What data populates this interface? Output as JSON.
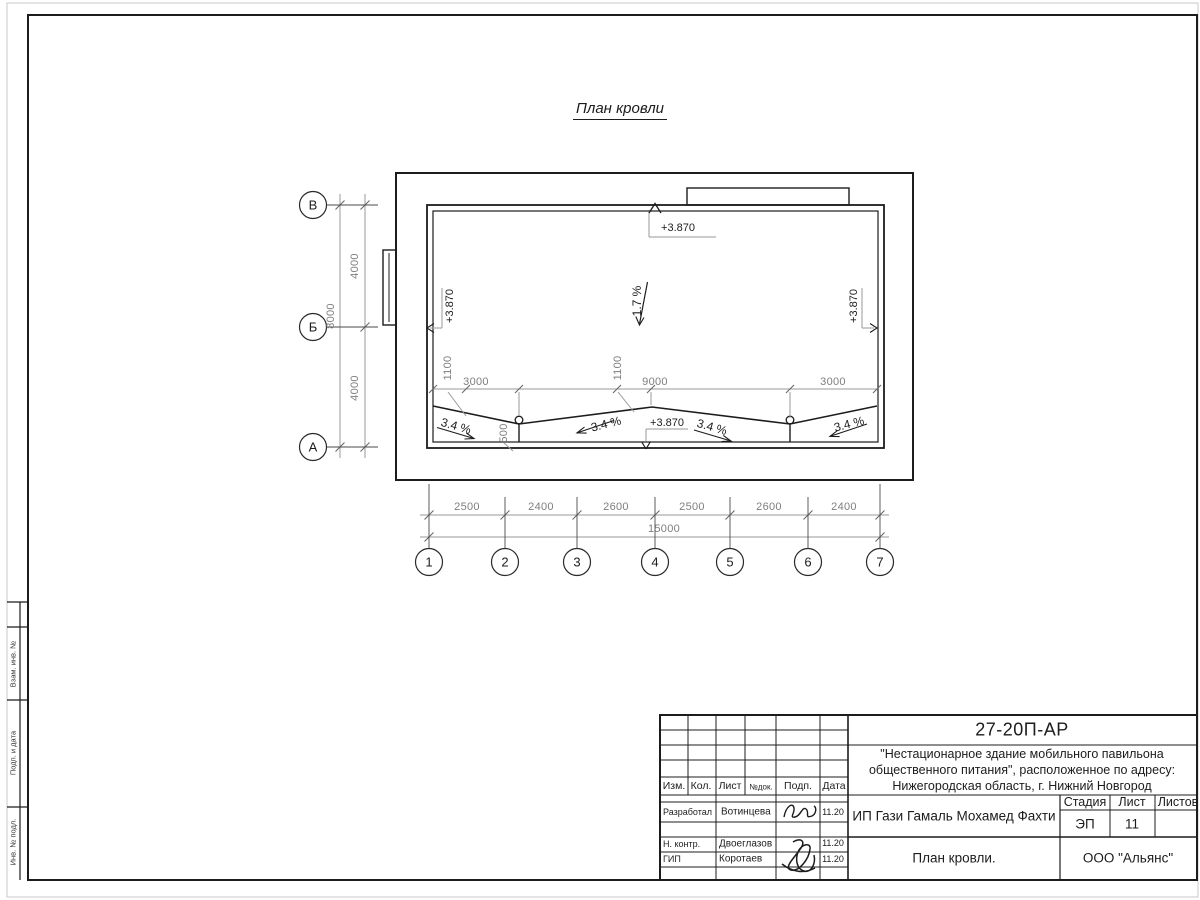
{
  "sheet": {
    "title": "План кровли",
    "side_strip": [
      "Взам. инв. №",
      "Подп. и дата",
      "Инв. № подл."
    ]
  },
  "plan": {
    "elevations": {
      "top": "+3.870",
      "left": "+3.870",
      "right": "+3.870",
      "ridge": "+3.870"
    },
    "main_slope": "1.7 %",
    "valley_slopes": [
      "3.4 %",
      "3.4 %",
      "3.4 %",
      "3.4 %"
    ]
  },
  "grid": {
    "rows": [
      "В",
      "Б",
      "А"
    ],
    "cols": [
      "1",
      "2",
      "3",
      "4",
      "5",
      "6",
      "7"
    ]
  },
  "dims": {
    "left": {
      "segments": [
        "4000",
        "4000"
      ],
      "total": "8000"
    },
    "bottom": {
      "segments": [
        "2500",
        "2400",
        "2600",
        "2500",
        "2600",
        "2400"
      ],
      "total": "15000"
    },
    "inner": {
      "labels": [
        "1100",
        "3000",
        "1100",
        "9000",
        "3000"
      ],
      "drain_depth": "500"
    }
  },
  "title_block": {
    "doc_number": "27-20П-АР",
    "project_lines": [
      "\"Нестационарное здание мобильного павильона",
      "общественного питания\", расположенное по адресу:",
      "Нижегородская область, г. Нижний Новгород"
    ],
    "client": "ИП Гази Гамаль Мохамед Фахти",
    "drawing_title": "План кровли.",
    "company": "ООО \"Альянс\"",
    "stage_label": "Стадия",
    "sheet_label": "Лист",
    "sheets_label": "Листов",
    "stage": "ЭП",
    "sheet_number": "11",
    "header_cols": [
      "Изм.",
      "Кол.",
      "Лист",
      "№док.",
      "Подп.",
      "Дата"
    ],
    "signoff_rows": [
      {
        "role": "Разработал",
        "name": "Вотинцева",
        "date": "11.20"
      },
      {
        "role": "Н. контр.",
        "name": "Двоеглазов",
        "date": "11.20"
      },
      {
        "role": "ГИП",
        "name": "Коротаев",
        "date": "11.20"
      }
    ]
  },
  "colors": {
    "ink": "#1c1c1c",
    "dim_gray": "#8a8a8a"
  }
}
